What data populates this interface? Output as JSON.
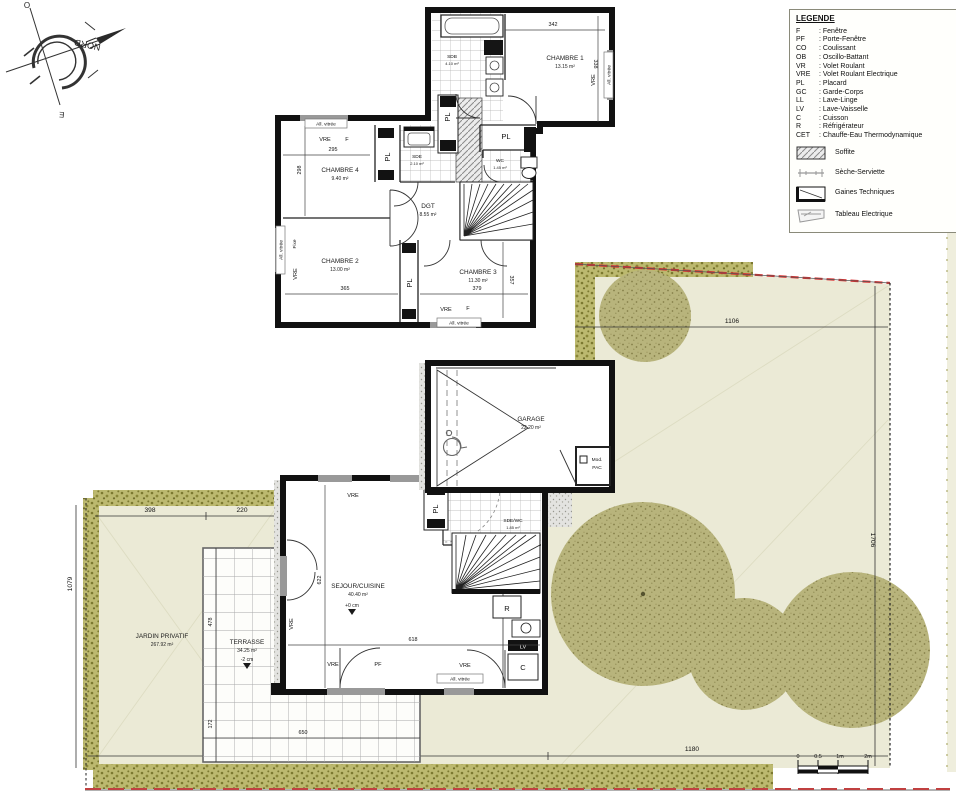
{
  "compass": {
    "north": "NORD",
    "west": "O",
    "east": "E"
  },
  "legend": {
    "title": "LEGENDE",
    "items": [
      {
        "abbr": "F",
        "desc": ": Fenêtre"
      },
      {
        "abbr": "PF",
        "desc": ": Porte-Fenêtre"
      },
      {
        "abbr": "CO",
        "desc": ": Coulissant"
      },
      {
        "abbr": "OB",
        "desc": ": Oscillo-Battant"
      },
      {
        "abbr": "VR",
        "desc": ": Volet Roulant"
      },
      {
        "abbr": "VRE",
        "desc": ": Volet Roulant Electrique"
      },
      {
        "abbr": "PL",
        "desc": ": Placard"
      },
      {
        "abbr": "GC",
        "desc": ": Garde-Corps"
      },
      {
        "abbr": "LL",
        "desc": ": Lave-Linge"
      },
      {
        "abbr": "LV",
        "desc": ": Lave-Vaisselle"
      },
      {
        "abbr": "C",
        "desc": ": Cuisson"
      },
      {
        "abbr": "R",
        "desc": ": Réfrigérateur"
      },
      {
        "abbr": "CET",
        "desc": ": Chauffe-Eau Thermodynamique"
      }
    ],
    "symbols": [
      {
        "label": "Soffite"
      },
      {
        "label": "Sèche-Serviette"
      },
      {
        "label": "Gaines Techniques"
      },
      {
        "label": "Tableau Electrique"
      }
    ]
  },
  "tags": {
    "pl": "PL",
    "vre": "VRE",
    "f": "F",
    "fixe": "Fixe",
    "ob": "OB",
    "pf": "PF",
    "allvitree": "All. vitrée"
  },
  "upper": {
    "rooms": {
      "chambre1": {
        "name": "CHAMBRE 1",
        "area": "13.15 m²"
      },
      "chambre2": {
        "name": "CHAMBRE 2",
        "area": "13.00 m²"
      },
      "chambre3": {
        "name": "CHAMBRE 3",
        "area": "11.30 m²"
      },
      "chambre4": {
        "name": "CHAMBRE 4",
        "area": "9.40 m²"
      },
      "sdb": {
        "name": "SDB",
        "area": "4.10 m²"
      },
      "sde": {
        "name": "SDE",
        "area": "2.10 m²"
      },
      "wc": {
        "name": "WC",
        "area": "1.45 m²"
      },
      "dgt": {
        "name": "DGT",
        "area": "8.55 m²"
      }
    },
    "dims": {
      "w342": "342",
      "h338": "338",
      "w295": "295",
      "h298": "298",
      "w365": "365",
      "w379": "379",
      "h357": "357"
    }
  },
  "ground": {
    "rooms": {
      "garage": {
        "name": "GARAGE",
        "area": "22.20 m²"
      },
      "sejour": {
        "name": "SEJOUR/CUISINE",
        "area": "40.40 m²"
      },
      "sdewc": {
        "name": "SDE/WC",
        "area": "1.85 m²"
      }
    },
    "labels": {
      "modpac1": "Mod.",
      "modpac2": "PAC",
      "level": "+0 cm",
      "r": "R",
      "lv": "LV",
      "c": "C"
    },
    "dims": {
      "w618": "618",
      "h622": "622"
    }
  },
  "site": {
    "jardin": {
      "name": "JARDIN PRIVATIF",
      "area": "267.92 m²"
    },
    "terrasse": {
      "name": "TERRASSE",
      "area": "34.25 m²",
      "level": "-2 cm"
    },
    "dims": {
      "w1106": "1106",
      "h1706": "1706",
      "w1576": "1576",
      "w1180": "1180",
      "w398": "398",
      "w220": "220",
      "h1079": "1079",
      "h478": "478",
      "h172": "172",
      "w650": "650"
    },
    "scale": {
      "t0": "0",
      "t05": "0.5",
      "t1": "1m",
      "t2": "2m"
    }
  }
}
